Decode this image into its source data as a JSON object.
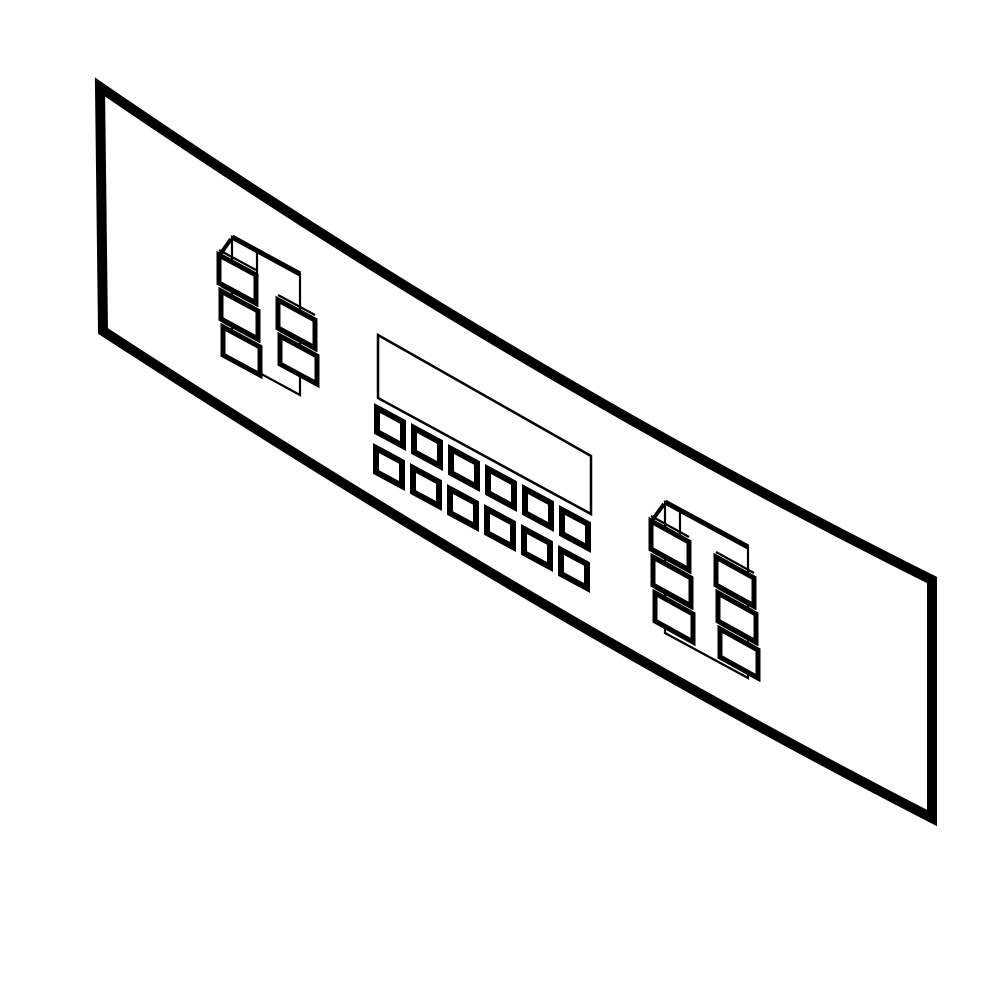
{
  "meta": {
    "description": "Black-and-white isometric technical line drawing of an appliance (range/oven) membrane control panel overlay, angled from upper-left to lower-right, with two membrane key clusters, a display window and a 12-key keypad",
    "background_color": "#ffffff",
    "line_color": "#000000",
    "canvas": {
      "width": 1000,
      "height": 1000
    }
  },
  "diagram": {
    "shapes": [
      {
        "name": "panel-outline",
        "part": "control-panel-face",
        "type": "path",
        "d": "M 100 87 Q 520 375 932 580 L 932 818 Q 550 622 103 331 Z",
        "fill": "#ffffff",
        "stroke_width": 10
      },
      {
        "name": "display-window",
        "part": "display-window-outline",
        "type": "polygon",
        "points": [
          [
            378,
            335
          ],
          [
            591,
            456
          ],
          [
            591,
            514
          ],
          [
            378,
            398
          ]
        ],
        "fill": "#ffffff",
        "stroke_width": 2.5
      },
      {
        "name": "left-cluster-box",
        "part": "left-key-cluster",
        "type": "polygon",
        "points": [
          [
            232,
            237
          ],
          [
            300,
            274
          ],
          [
            300,
            395
          ],
          [
            232,
            358
          ]
        ],
        "fill": "none",
        "stroke_width": 2.2
      },
      {
        "name": "left-cluster-lid",
        "part": "left-key-cluster",
        "type": "line",
        "x1": 232,
        "y1": 237,
        "x2": 300,
        "y2": 274,
        "stroke_width": 5
      },
      {
        "name": "left-cluster-divider",
        "part": "left-key-cluster",
        "type": "line",
        "x1": 257,
        "y1": 251,
        "x2": 257,
        "y2": 276,
        "stroke_width": 2.2
      },
      {
        "name": "left-cluster-connector",
        "part": "left-key-cluster",
        "type": "line",
        "x1": 219,
        "y1": 256,
        "x2": 231,
        "y2": 239,
        "stroke_width": 4
      },
      {
        "name": "key-echo-line",
        "part": "left-key-cluster",
        "type": "line",
        "x1": 219,
        "y1": 250,
        "x2": 256,
        "y2": 270,
        "stroke_width": 2.2
      },
      {
        "name": "key-echo-line",
        "part": "left-key-cluster",
        "type": "line",
        "x1": 221,
        "y1": 286,
        "x2": 258,
        "y2": 306,
        "stroke_width": 2.2
      },
      {
        "name": "key-echo-line",
        "part": "left-key-cluster",
        "type": "line",
        "x1": 223,
        "y1": 322,
        "x2": 260,
        "y2": 342,
        "stroke_width": 2.2
      },
      {
        "name": "key-echo-line",
        "part": "left-key-cluster",
        "type": "line",
        "x1": 278,
        "y1": 295,
        "x2": 315,
        "y2": 315,
        "stroke_width": 2.2
      },
      {
        "name": "key-echo-line",
        "part": "left-key-cluster",
        "type": "line",
        "x1": 280,
        "y1": 331,
        "x2": 317,
        "y2": 351,
        "stroke_width": 2.2
      },
      {
        "name": "membrane-key",
        "part": "left-key-cluster",
        "type": "polygon",
        "points": [
          [
            219,
            255
          ],
          [
            256,
            275
          ],
          [
            256,
            303
          ],
          [
            219,
            283
          ]
        ],
        "fill": "#ffffff",
        "stroke_width": 5
      },
      {
        "name": "membrane-key",
        "part": "left-key-cluster",
        "type": "polygon",
        "points": [
          [
            221,
            291
          ],
          [
            258,
            311
          ],
          [
            258,
            339
          ],
          [
            221,
            319
          ]
        ],
        "fill": "#ffffff",
        "stroke_width": 5
      },
      {
        "name": "membrane-key",
        "part": "left-key-cluster",
        "type": "polygon",
        "points": [
          [
            223,
            327
          ],
          [
            260,
            347
          ],
          [
            260,
            375
          ],
          [
            223,
            355
          ]
        ],
        "fill": "#ffffff",
        "stroke_width": 5
      },
      {
        "name": "membrane-key",
        "part": "left-key-cluster",
        "type": "polygon",
        "points": [
          [
            278,
            300
          ],
          [
            315,
            320
          ],
          [
            315,
            348
          ],
          [
            278,
            328
          ]
        ],
        "fill": "#ffffff",
        "stroke_width": 5
      },
      {
        "name": "membrane-key",
        "part": "left-key-cluster",
        "type": "polygon",
        "points": [
          [
            280,
            336
          ],
          [
            317,
            356
          ],
          [
            317,
            384
          ],
          [
            280,
            364
          ]
        ],
        "fill": "#ffffff",
        "stroke_width": 5
      },
      {
        "name": "right-cluster-box",
        "part": "right-key-cluster",
        "type": "polygon",
        "points": [
          [
            665,
            502
          ],
          [
            748,
            547
          ],
          [
            748,
            678
          ],
          [
            665,
            633
          ]
        ],
        "fill": "none",
        "stroke_width": 2.2
      },
      {
        "name": "right-cluster-lid",
        "part": "right-key-cluster",
        "type": "line",
        "x1": 665,
        "y1": 502,
        "x2": 748,
        "y2": 547,
        "stroke_width": 5
      },
      {
        "name": "right-cluster-divider",
        "part": "right-key-cluster",
        "type": "line",
        "x1": 680,
        "y1": 510,
        "x2": 680,
        "y2": 537,
        "stroke_width": 2.2
      },
      {
        "name": "right-cluster-connector",
        "part": "right-key-cluster",
        "type": "line",
        "x1": 651,
        "y1": 522,
        "x2": 664,
        "y2": 504,
        "stroke_width": 4
      },
      {
        "name": "key-echo-line",
        "part": "right-key-cluster",
        "type": "line",
        "x1": 651,
        "y1": 516,
        "x2": 689,
        "y2": 537,
        "stroke_width": 2.2
      },
      {
        "name": "key-echo-line",
        "part": "right-key-cluster",
        "type": "line",
        "x1": 653,
        "y1": 552,
        "x2": 691,
        "y2": 573,
        "stroke_width": 2.2
      },
      {
        "name": "key-echo-line",
        "part": "right-key-cluster",
        "type": "line",
        "x1": 655,
        "y1": 588,
        "x2": 693,
        "y2": 609,
        "stroke_width": 2.2
      },
      {
        "name": "key-echo-line",
        "part": "right-key-cluster",
        "type": "line",
        "x1": 716,
        "y1": 552,
        "x2": 754,
        "y2": 573,
        "stroke_width": 2.2
      },
      {
        "name": "key-echo-line",
        "part": "right-key-cluster",
        "type": "line",
        "x1": 718,
        "y1": 588,
        "x2": 756,
        "y2": 609,
        "stroke_width": 2.2
      },
      {
        "name": "key-echo-line",
        "part": "right-key-cluster",
        "type": "line",
        "x1": 720,
        "y1": 624,
        "x2": 758,
        "y2": 645,
        "stroke_width": 2.2
      },
      {
        "name": "membrane-key",
        "part": "right-key-cluster",
        "type": "polygon",
        "points": [
          [
            651,
            521
          ],
          [
            689,
            542
          ],
          [
            689,
            570
          ],
          [
            651,
            549
          ]
        ],
        "fill": "#ffffff",
        "stroke_width": 5
      },
      {
        "name": "membrane-key",
        "part": "right-key-cluster",
        "type": "polygon",
        "points": [
          [
            653,
            557
          ],
          [
            691,
            578
          ],
          [
            691,
            606
          ],
          [
            653,
            585
          ]
        ],
        "fill": "#ffffff",
        "stroke_width": 5
      },
      {
        "name": "membrane-key",
        "part": "right-key-cluster",
        "type": "polygon",
        "points": [
          [
            655,
            593
          ],
          [
            693,
            614
          ],
          [
            693,
            642
          ],
          [
            655,
            621
          ]
        ],
        "fill": "#ffffff",
        "stroke_width": 5
      },
      {
        "name": "membrane-key",
        "part": "right-key-cluster",
        "type": "polygon",
        "points": [
          [
            716,
            557
          ],
          [
            754,
            578
          ],
          [
            754,
            606
          ],
          [
            716,
            585
          ]
        ],
        "fill": "#ffffff",
        "stroke_width": 5
      },
      {
        "name": "membrane-key",
        "part": "right-key-cluster",
        "type": "polygon",
        "points": [
          [
            718,
            593
          ],
          [
            756,
            614
          ],
          [
            756,
            642
          ],
          [
            718,
            621
          ]
        ],
        "fill": "#ffffff",
        "stroke_width": 5
      },
      {
        "name": "membrane-key",
        "part": "right-key-cluster",
        "type": "polygon",
        "points": [
          [
            720,
            629
          ],
          [
            758,
            650
          ],
          [
            758,
            678
          ],
          [
            720,
            657
          ]
        ],
        "fill": "#ffffff",
        "stroke_width": 5
      },
      {
        "name": "keypad-key",
        "part": "center-keypad-row-1",
        "type": "polygon",
        "points": [
          [
            377,
            408
          ],
          [
            403,
            422
          ],
          [
            403,
            446
          ],
          [
            377,
            432
          ]
        ],
        "fill": "#ffffff",
        "stroke_width": 6
      },
      {
        "name": "keypad-key",
        "part": "center-keypad-row-1",
        "type": "polygon",
        "points": [
          [
            414,
            428
          ],
          [
            440,
            442
          ],
          [
            440,
            466
          ],
          [
            414,
            452
          ]
        ],
        "fill": "#ffffff",
        "stroke_width": 6
      },
      {
        "name": "keypad-key",
        "part": "center-keypad-row-1",
        "type": "polygon",
        "points": [
          [
            451,
            449
          ],
          [
            477,
            463
          ],
          [
            477,
            487
          ],
          [
            451,
            473
          ]
        ],
        "fill": "#ffffff",
        "stroke_width": 6
      },
      {
        "name": "keypad-key",
        "part": "center-keypad-row-1",
        "type": "polygon",
        "points": [
          [
            488,
            469
          ],
          [
            514,
            483
          ],
          [
            514,
            507
          ],
          [
            488,
            493
          ]
        ],
        "fill": "#ffffff",
        "stroke_width": 6
      },
      {
        "name": "keypad-key",
        "part": "center-keypad-row-1",
        "type": "polygon",
        "points": [
          [
            525,
            489
          ],
          [
            551,
            503
          ],
          [
            551,
            527
          ],
          [
            525,
            513
          ]
        ],
        "fill": "#ffffff",
        "stroke_width": 6
      },
      {
        "name": "keypad-key",
        "part": "center-keypad-row-1",
        "type": "polygon",
        "points": [
          [
            562,
            510
          ],
          [
            588,
            524
          ],
          [
            588,
            548
          ],
          [
            562,
            534
          ]
        ],
        "fill": "#ffffff",
        "stroke_width": 6
      },
      {
        "name": "keypad-key",
        "part": "center-keypad-row-2",
        "type": "polygon",
        "points": [
          [
            376,
            448
          ],
          [
            402,
            462
          ],
          [
            402,
            486
          ],
          [
            376,
            472
          ]
        ],
        "fill": "#ffffff",
        "stroke_width": 6
      },
      {
        "name": "keypad-key",
        "part": "center-keypad-row-2",
        "type": "polygon",
        "points": [
          [
            413,
            468
          ],
          [
            439,
            482
          ],
          [
            439,
            506
          ],
          [
            413,
            492
          ]
        ],
        "fill": "#ffffff",
        "stroke_width": 6
      },
      {
        "name": "keypad-key",
        "part": "center-keypad-row-2",
        "type": "polygon",
        "points": [
          [
            450,
            489
          ],
          [
            476,
            503
          ],
          [
            476,
            527
          ],
          [
            450,
            513
          ]
        ],
        "fill": "#ffffff",
        "stroke_width": 6
      },
      {
        "name": "keypad-key",
        "part": "center-keypad-row-2",
        "type": "polygon",
        "points": [
          [
            487,
            509
          ],
          [
            513,
            523
          ],
          [
            513,
            547
          ],
          [
            487,
            533
          ]
        ],
        "fill": "#ffffff",
        "stroke_width": 6
      },
      {
        "name": "keypad-key",
        "part": "center-keypad-row-2",
        "type": "polygon",
        "points": [
          [
            524,
            529
          ],
          [
            550,
            543
          ],
          [
            550,
            567
          ],
          [
            524,
            553
          ]
        ],
        "fill": "#ffffff",
        "stroke_width": 6
      },
      {
        "name": "keypad-key",
        "part": "center-keypad-row-2",
        "type": "polygon",
        "points": [
          [
            561,
            550
          ],
          [
            587,
            564
          ],
          [
            587,
            588
          ],
          [
            561,
            574
          ]
        ],
        "fill": "#ffffff",
        "stroke_width": 6
      }
    ]
  }
}
